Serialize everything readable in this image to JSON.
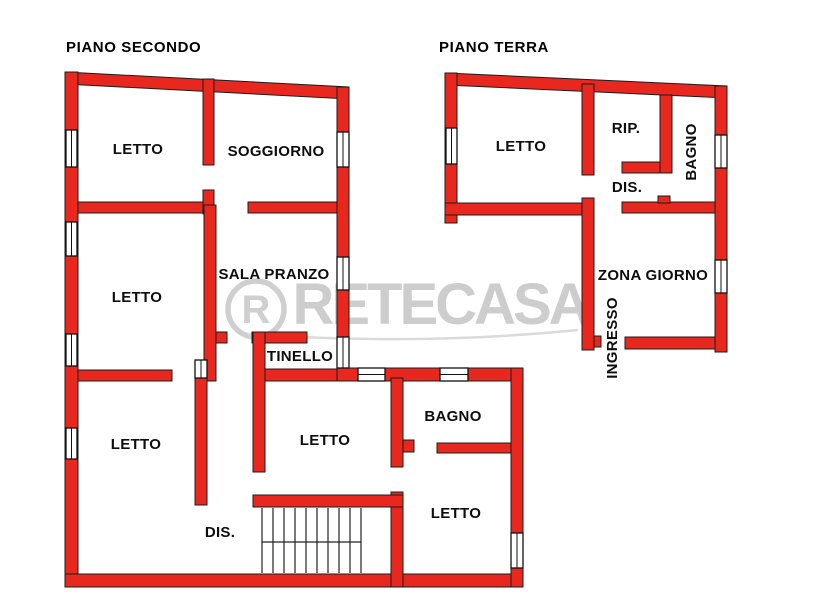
{
  "colors": {
    "wall_red": "#e8281e",
    "wall_outline": "#1c1c1c",
    "label_black": "#0d0d0d",
    "watermark_grey": "#cdcdcd",
    "background": "#ffffff"
  },
  "watermark": {
    "text": "RETECASA",
    "logo_letter": "R"
  },
  "plans": [
    {
      "name": "piano-secondo",
      "title": "PIANO SECONDO",
      "rooms": [
        {
          "name": "letto-nordovest",
          "label": "LETTO"
        },
        {
          "name": "soggiorno",
          "label": "SOGGIORNO"
        },
        {
          "name": "letto-ovest",
          "label": "LETTO"
        },
        {
          "name": "sala-pranzo",
          "label": "SALA PRANZO"
        },
        {
          "name": "tinello",
          "label": "TINELLO"
        },
        {
          "name": "letto-sudovest",
          "label": "LETTO"
        },
        {
          "name": "letto-centrale",
          "label": "LETTO"
        },
        {
          "name": "bagno",
          "label": "BAGNO"
        },
        {
          "name": "letto-sudest",
          "label": "LETTO"
        },
        {
          "name": "disimpegno",
          "label": "DIS."
        }
      ]
    },
    {
      "name": "piano-terra",
      "title": "PIANO TERRA",
      "rooms": [
        {
          "name": "letto",
          "label": "LETTO"
        },
        {
          "name": "ripostiglio",
          "label": "RIP."
        },
        {
          "name": "bagno",
          "label": "BAGNO"
        },
        {
          "name": "disimpegno",
          "label": "DIS."
        },
        {
          "name": "zona-giorno",
          "label": "ZONA GIORNO"
        },
        {
          "name": "ingresso",
          "label": "INGRESSO"
        }
      ]
    }
  ]
}
